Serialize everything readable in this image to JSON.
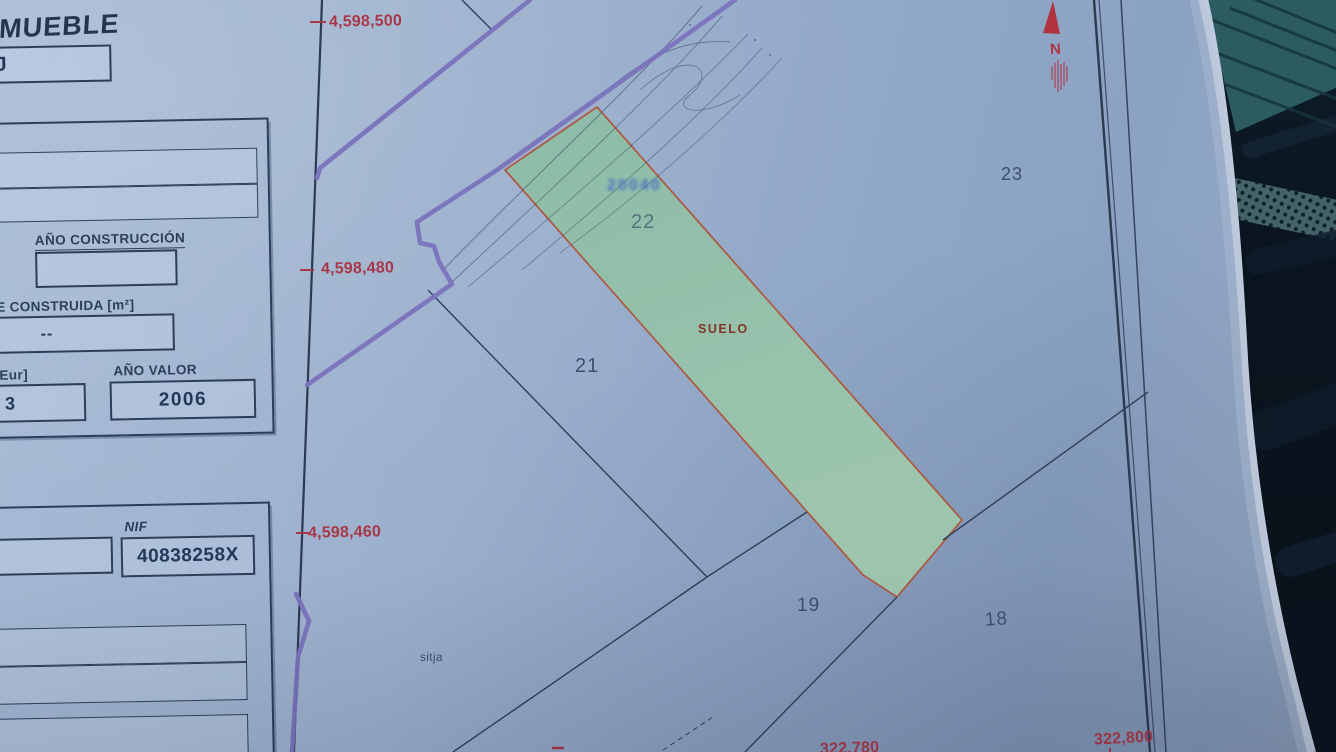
{
  "header": {
    "title_fragment": "NMUEBLE",
    "box_fragment": "J"
  },
  "fields": {
    "ano_construccion_label": "AÑO CONSTRUCCIÓN",
    "ano_construccion_value": "",
    "superficie_label": "E CONSTRUIDA [m²]",
    "superficie_value": "--",
    "eur_label": "Eur]",
    "eur_value": "3",
    "ano_valor_label": "AÑO VALOR",
    "ano_valor_value": "2006",
    "nif_label": "NIF",
    "nif_value": "40838258X"
  },
  "map": {
    "grid_labels_left": [
      "4,598,500",
      "4,598,480",
      "4,598,460"
    ],
    "grid_labels_bottom": [
      "322,780",
      "322,800"
    ],
    "parcel_numbers": [
      "18",
      "19",
      "21",
      "22",
      "23"
    ],
    "land_use_label": "SUELO",
    "feature_label": "sitja",
    "blue_reference": "20040",
    "north_label": "N"
  },
  "colors": {
    "paper": "#9bb0cd",
    "ink": "#2e4059",
    "grid_red": "#a83848",
    "parcel_green_fill": "#94c0a8",
    "parcel_green_border": "#ad5a45",
    "boundary_purple": "#7b73bd",
    "north_red": "#b23340",
    "background_dark": "#0b151f",
    "glass_teal": "#2c5c62"
  }
}
